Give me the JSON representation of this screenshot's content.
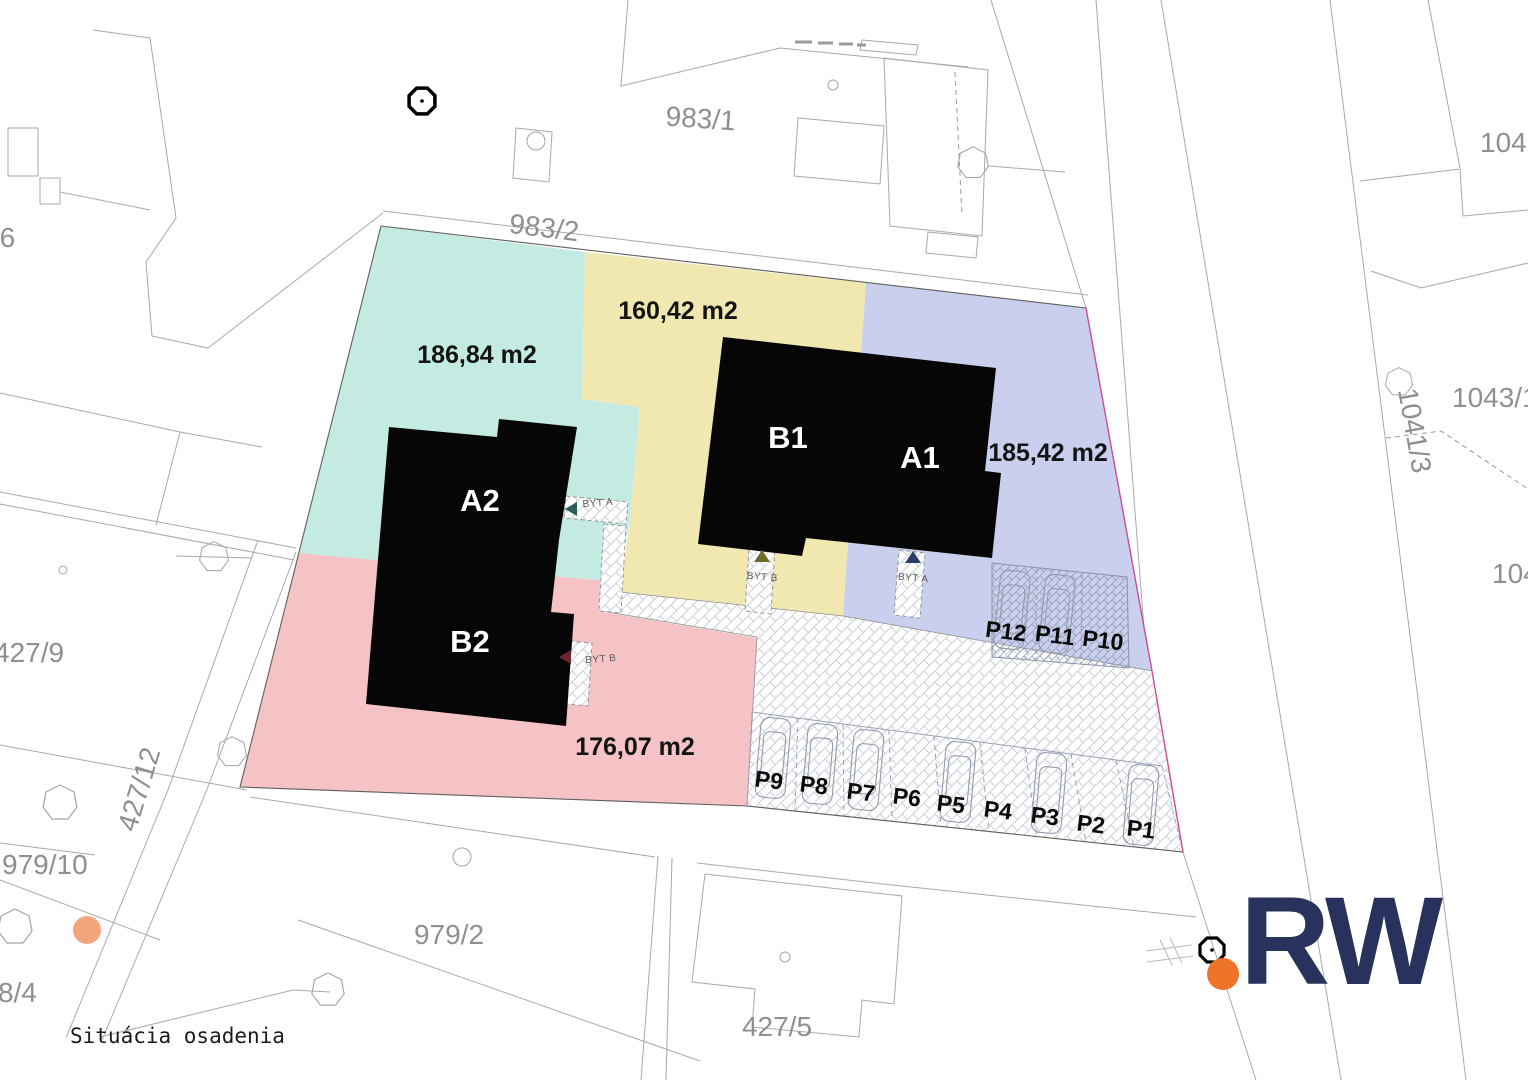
{
  "plan": {
    "title": "Situácia osadenia"
  },
  "zones": {
    "teal": {
      "area": "186,84 m2",
      "color": "#c3ebe2"
    },
    "yellow": {
      "area": "160,42 m2",
      "color": "#f0e8b0"
    },
    "blue": {
      "area": "185,42 m2",
      "color": "#c9cfed"
    },
    "pink": {
      "area": "176,07 m2",
      "color": "#f5c3c6"
    }
  },
  "buildings": {
    "a2": "A2",
    "b2": "B2",
    "b1": "B1",
    "a1": "A1"
  },
  "entrances": {
    "a2": "BYT A",
    "b2": "BYT B",
    "b1": "BYT B",
    "a1": "BYT A"
  },
  "parking": {
    "row": [
      "P9",
      "P8",
      "P7",
      "P6",
      "P5",
      "P4",
      "P3",
      "P2",
      "P1"
    ],
    "upper": [
      "P12",
      "P11",
      "P10"
    ]
  },
  "parcels": {
    "p983_1": "983/1",
    "p983_2": "983/2",
    "p1045": "1045",
    "p1043_1": "1043/1",
    "p1041_3": "1041/3",
    "p104": "104",
    "p96": "96",
    "p427_9": "427/9",
    "p427_12": "427/12",
    "p979_10": "979/10",
    "p8_4": "8/4",
    "p979_2": "979/2",
    "p427_5": "427/5"
  },
  "logo": {
    "text": "RW",
    "color": "#28325c",
    "dot_color": "#ee7428"
  },
  "markers": {
    "survey_color": "#000000",
    "tree_dot_color": "#f5a57e"
  }
}
